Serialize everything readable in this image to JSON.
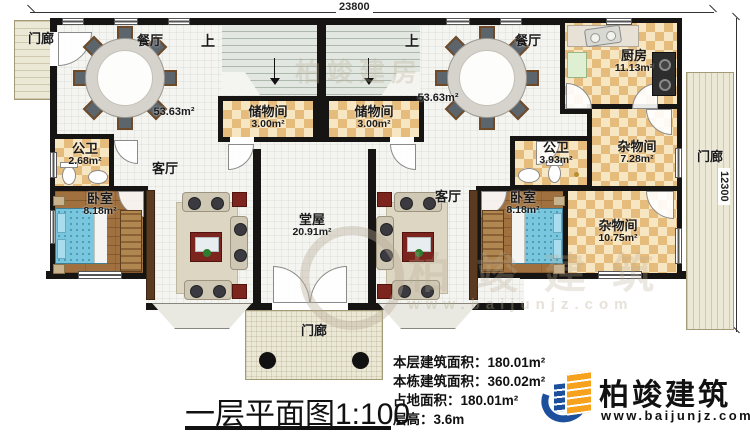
{
  "dimensions": {
    "width_mm": "23800",
    "height_mm": "12300"
  },
  "rooms": {
    "porch_top_left": {
      "name": "门廊"
    },
    "porch_right": {
      "name": "门廊"
    },
    "porch_front": {
      "name": "门廊"
    },
    "stairs_left": {
      "name": "上"
    },
    "stairs_right": {
      "name": "上"
    },
    "dining_left": {
      "name": "餐厅",
      "area": "53.63m²"
    },
    "dining_right": {
      "name": "餐厅",
      "area": "53.63m²"
    },
    "storage_left": {
      "name": "储物间",
      "area": "3.00m²"
    },
    "storage_right": {
      "name": "储物间",
      "area": "3.00m²"
    },
    "kitchen": {
      "name": "厨房",
      "area": "11.13m²"
    },
    "bath_left": {
      "name": "公卫",
      "area": "2.68m²"
    },
    "bath_right": {
      "name": "公卫",
      "area": "3.93m²"
    },
    "living_left": {
      "name": "客厅"
    },
    "living_right": {
      "name": "客厅"
    },
    "bedroom_left": {
      "name": "卧室",
      "area": "8.18m²"
    },
    "bedroom_right": {
      "name": "卧室",
      "area": "8.18m²"
    },
    "utility_right_upper": {
      "name": "杂物间",
      "area": "7.28m²"
    },
    "utility_right_lower": {
      "name": "杂物间",
      "area": "10.75m²"
    },
    "hall": {
      "name": "堂屋",
      "area": "20.91m²"
    }
  },
  "footer": {
    "title": "一层平面图",
    "scale": "1:100",
    "stats": [
      {
        "label": "本层建筑面积：",
        "value": "180.01m²"
      },
      {
        "label": "本栋建筑面积：",
        "value": "360.02m²"
      },
      {
        "label": "占地面积：",
        "value": "180.01m²"
      },
      {
        "label": "层高：",
        "value": "3.6m"
      }
    ]
  },
  "logo": {
    "name": "柏竣建筑",
    "website": "www.baijunjz.com"
  },
  "watermark": {
    "brand": "柏竣建房",
    "brand2": "柏竣建筑",
    "website": "www.baijunjz.com"
  },
  "colors": {
    "wall": "#171513",
    "checker": "#e6bc7c",
    "accent_blue": "#1c4f9c",
    "accent_orange": "#f6a21c",
    "bed": "#79c7de"
  }
}
